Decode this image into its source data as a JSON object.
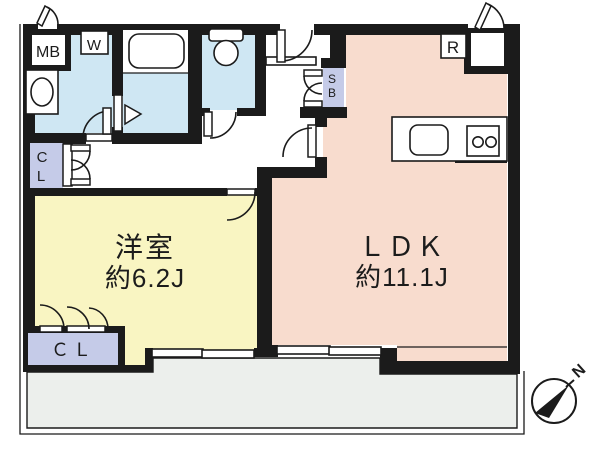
{
  "plan": {
    "rooms": {
      "western": {
        "label": "洋室",
        "area": "約6.2J"
      },
      "ldk": {
        "label": "ＬＤＫ",
        "area": "約11.1J"
      }
    },
    "labels": {
      "meter_box": "MB",
      "washer": "W",
      "refrigerator": "R",
      "shoe_box_line1": "S",
      "shoe_box_line2": "B",
      "closet_upper_line1": "C",
      "closet_upper_line2": "L",
      "closet_lower": "ＣＬ",
      "north": "N"
    },
    "colors": {
      "wall": "#1b1b1b",
      "water_blue": "#cfe7f3",
      "room_yellow": "#f9f5c2",
      "ldk_pink": "#f8dcce",
      "storage_lavender": "#c5cbe8",
      "balcony_gray": "#ecefec",
      "white": "#ffffff"
    }
  }
}
